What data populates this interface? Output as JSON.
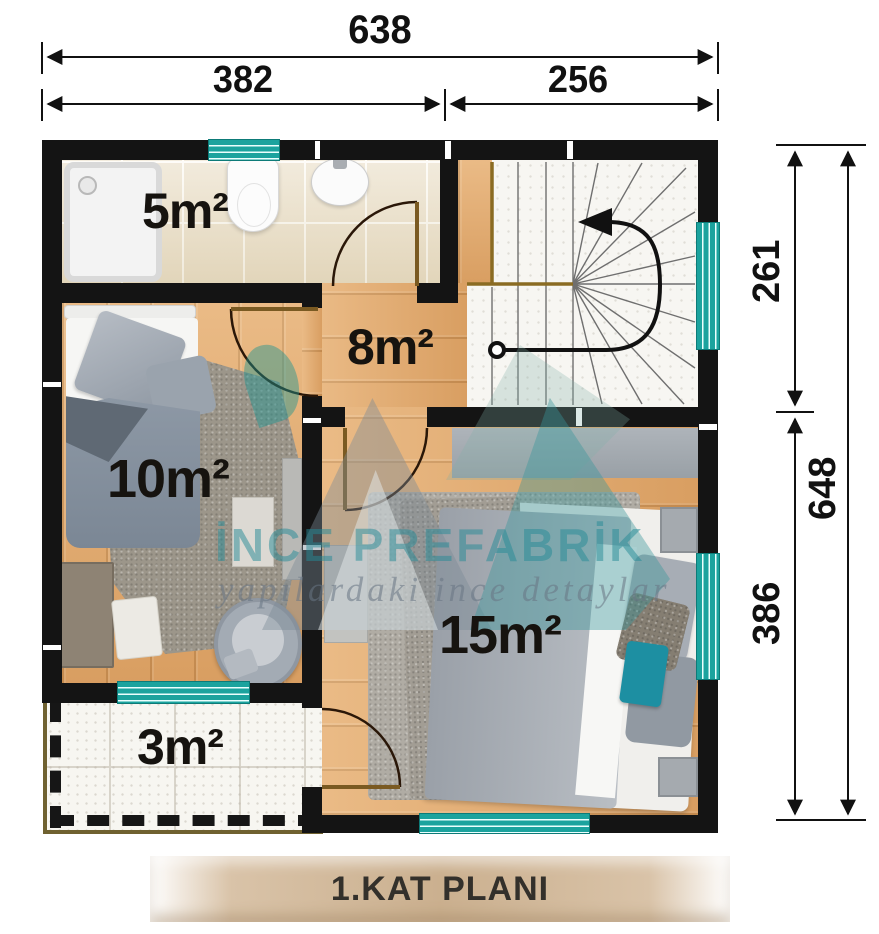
{
  "plan": {
    "title": "1.KAT PLANI"
  },
  "dimensions": {
    "top": {
      "total": "638",
      "left_segment": "382",
      "right_segment": "256"
    },
    "right": {
      "upper_segment": "261",
      "lower_segment": "386",
      "total": "648"
    }
  },
  "rooms": {
    "bathroom": {
      "area": "5m²"
    },
    "hallway": {
      "area": "8m²"
    },
    "bedroom_small": {
      "area": "10m²"
    },
    "bedroom_large": {
      "area": "15m²"
    },
    "balcony": {
      "area": "3m²"
    }
  },
  "watermark": {
    "brand": "İNCE PREFABRİK",
    "tagline": "yapılardaki ince detaylar"
  },
  "colors": {
    "wall": "#141414",
    "window_frame": "#1ba39e",
    "wood_floor": "#e3aa6e",
    "accent_pillow": "#1d8fa2",
    "title_band": "#cbb08f",
    "stair_edge": "#8a6b22"
  }
}
